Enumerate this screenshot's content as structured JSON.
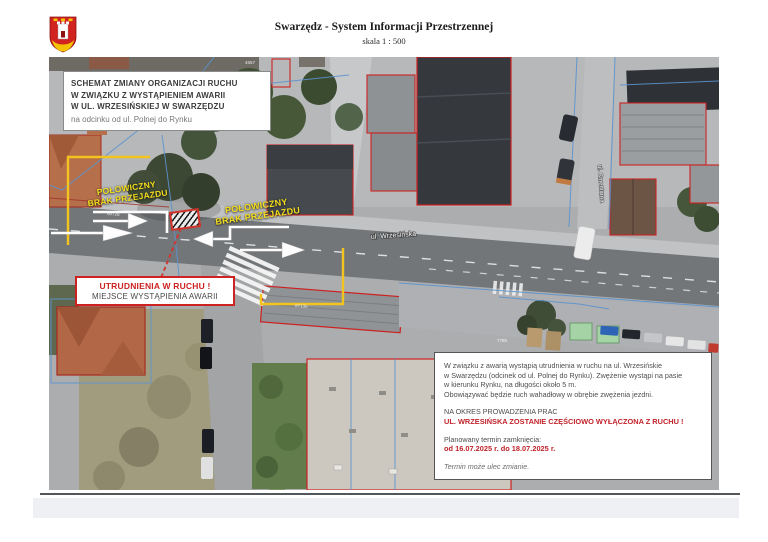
{
  "header": {
    "title": "Swarzędz - System Informacji Przestrzennej",
    "scale": "skala 1 : 500"
  },
  "map": {
    "scheme_box": {
      "l1": "SCHEMAT ZMIANY ORGANIZACJI RUCHU",
      "l2": "W ZWIĄZKU Z WYSTĄPIENIEM AWARII",
      "l3": "W UL. WRZESIŃSKIEJ W SWARZĘDZU",
      "l4": "na odcinku od ul. Polnej do Rynku"
    },
    "closure_left": {
      "line1": "POŁOWICZNY",
      "line2": "BRAK PRZEJAZDU"
    },
    "closure_right": {
      "line1": "POŁOWICZNY",
      "line2": "BRAK PRZEJAZDU"
    },
    "warning_box": {
      "line1": "UTRUDNIENIA W RUCHU !",
      "line2": "MIEJSCE WYSTĄPIENIA AWARII"
    },
    "info_box": {
      "p1": [
        "W związku z awarią wystąpią utrudnienia w ruchu na ul. Wrzesińskie",
        "w Swarzędzu (odcinek od ul. Polnej do Rynku). Zwężenie wystąpi na pasie",
        "w kierunku Rynku, na długości około 5 m.",
        "Obowiązywać będzie ruch wahadłowy w obrębie zwężenia jezdni."
      ],
      "na_okres": "NA OKRES PROWADZENIA PRAC",
      "closed_line": "UL. WRZESIŃSKA ZOSTANIE CZĘŚCIOWO WYŁĄCZONA Z RUCHU !",
      "termin_label": "Planowany termin zamknięcia:",
      "termin_dates": "od 16.07.2025 r. do 18.07.2025 r.",
      "termin_note": "Termin może ulec zmianie."
    },
    "street_labels": {
      "wrzesinska": "ul. Wrzesińska",
      "cmentarna": "ul. Cmentarna"
    },
    "parcel_labels": [
      "60726",
      "60728",
      "67135",
      "7785",
      "4657"
    ]
  },
  "colors": {
    "closure_line_yellow": "#f2c41d",
    "closure_text_yellow": "#f6df1c",
    "warning_red": "#cc2222",
    "info_red": "#c0232a",
    "cadastral_blue": "#5b93cf",
    "cadastral_red": "#cc2222",
    "road_gray": "#737679",
    "logo_red": "#d12420",
    "logo_yellow": "#f3c200"
  }
}
